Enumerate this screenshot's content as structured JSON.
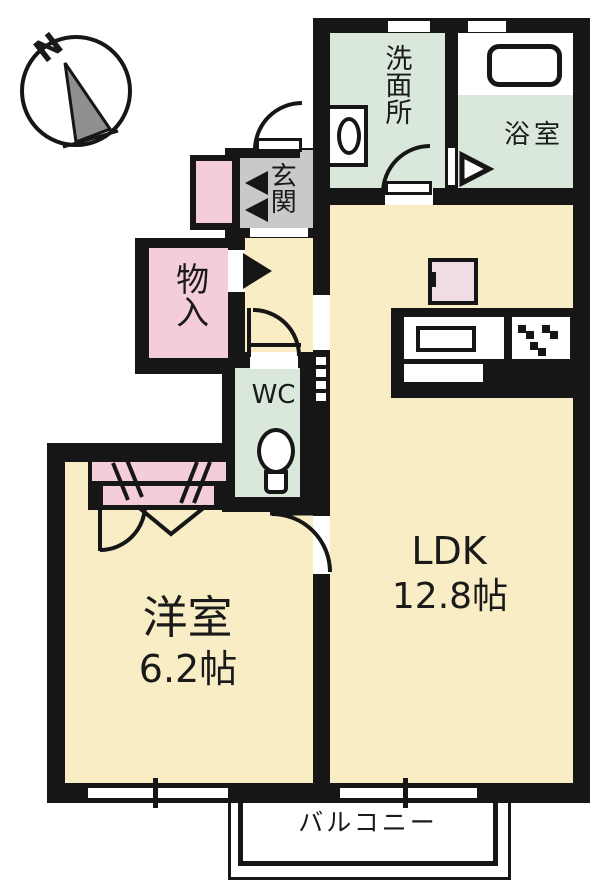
{
  "compass": {
    "north_label": "N"
  },
  "rooms": {
    "washroom": {
      "label": "洗面所"
    },
    "bath": {
      "label": "浴室"
    },
    "entrance": {
      "label": "玄関"
    },
    "storage": {
      "label": "物入"
    },
    "toilet": {
      "label": "WC"
    },
    "ldk": {
      "label": "LDK",
      "size": "12.8帖"
    },
    "western_room": {
      "label": "洋室",
      "size": "6.2帖"
    },
    "balcony": {
      "label": "バルコニー"
    }
  },
  "colors": {
    "floor_cream": "#F8EDC5",
    "wet_area_mint": "#D9E8DB",
    "closet_pink": "#F4CDD8",
    "entrance_gray": "#C9C9C9",
    "wall_black": "#161616",
    "appliance_pink": "#F0DCE3"
  }
}
